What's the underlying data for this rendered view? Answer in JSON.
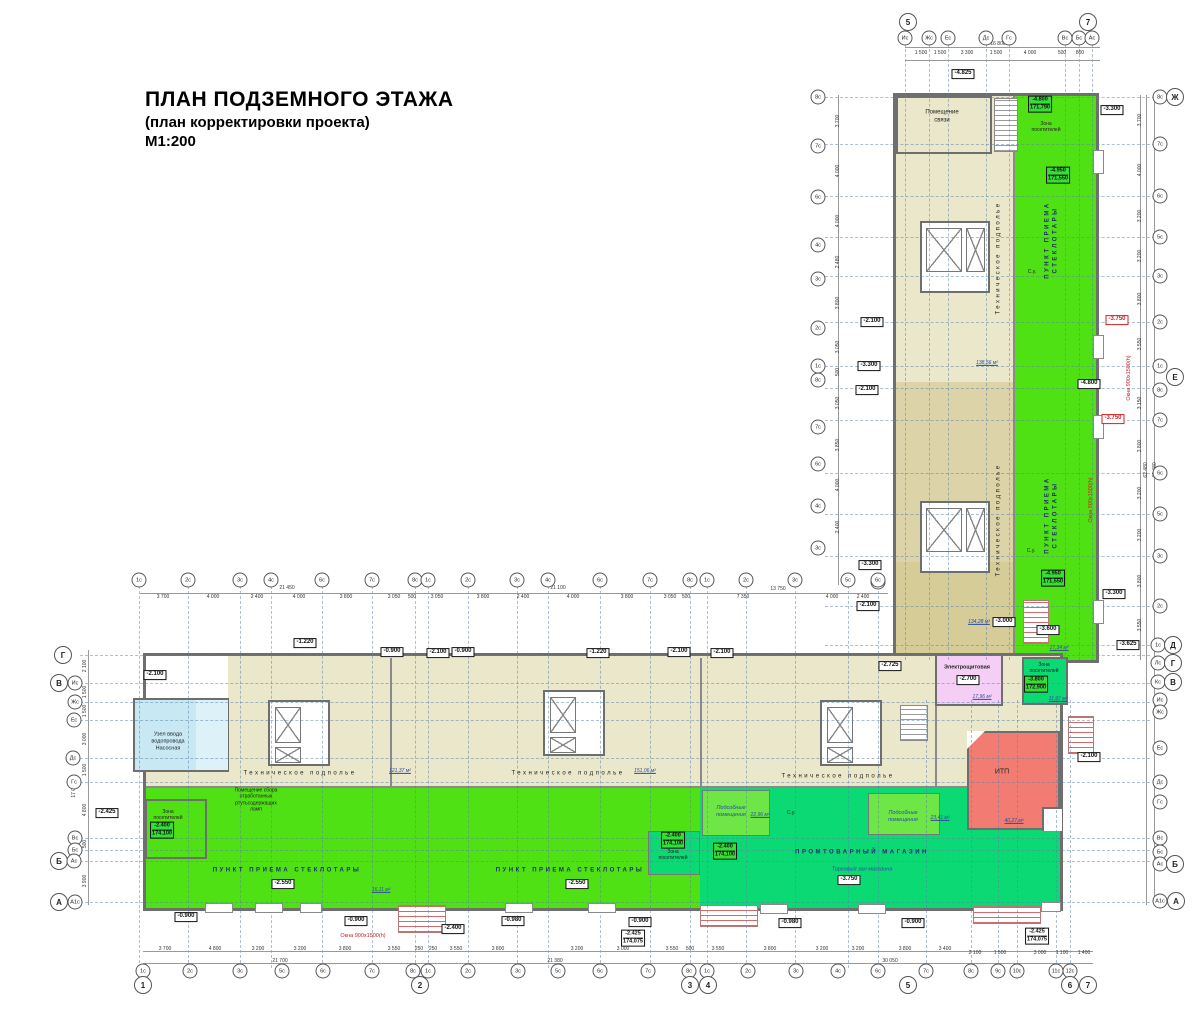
{
  "title": {
    "line1": "ПЛАН ПОДЗЕМНОГО ЭТАЖА",
    "line2": "(план корректировки проекта)",
    "line3": "М1:200"
  },
  "colors": {
    "technical_subfloor": "#ebe7ca",
    "glass_collection_point": "#50e114",
    "store": "#0bda74",
    "utility_rooms": "#6ee646",
    "water_inlet": "#c8e8f4",
    "electrical_room": "#f4cef4",
    "itp": "#f37c72",
    "note_red": "#cc2222",
    "label_navy": "#1b2f6b"
  },
  "rooms": {
    "communications": "Помещение связи",
    "technical_subfloor": "Техническое подполье",
    "glass_collection": "ПУНКТ ПРИЕМА СТЕКЛОТАРЫ",
    "store": "ПРОМТОВАРНЫЙ МАГАЗИН",
    "store_hall": "Торговый зал магазина",
    "utility": "Подсобные помещения",
    "visitors_zone": "Зона посетителей",
    "electrical": "Электрощитовая",
    "itp": "ИТП",
    "water_inlet": "Узел ввода водопровода Насосная",
    "lamp_collection": "Помещение сбора отработанных ртутьсодержащих ламп",
    "wc": "С.у."
  },
  "bubbles": [
    [
      "5",
      908,
      22,
      1
    ],
    [
      "7",
      1088,
      22,
      1
    ],
    [
      "Ис",
      905,
      38,
      0
    ],
    [
      "Жс",
      929,
      38,
      0
    ],
    [
      "Ес",
      948,
      38,
      0
    ],
    [
      "Дс",
      986,
      38,
      0
    ],
    [
      "Гс",
      1009,
      38,
      0
    ],
    [
      "Вс",
      1065,
      38,
      0
    ],
    [
      "Бс",
      1079,
      38,
      0
    ],
    [
      "Ас",
      1092,
      38,
      0
    ],
    [
      "8с",
      1160,
      97,
      0
    ],
    [
      "Ж",
      1175,
      97,
      1
    ],
    [
      "7с",
      1160,
      144,
      0
    ],
    [
      "6с",
      1160,
      196,
      0
    ],
    [
      "5с",
      1160,
      237,
      0
    ],
    [
      "3с",
      1160,
      276,
      0
    ],
    [
      "2с",
      1160,
      322,
      0
    ],
    [
      "1с",
      1160,
      366,
      0
    ],
    [
      "Е",
      1175,
      377,
      1
    ],
    [
      "8с",
      1160,
      390,
      0
    ],
    [
      "7с",
      1160,
      420,
      0
    ],
    [
      "6с",
      1160,
      473,
      0
    ],
    [
      "5с",
      1160,
      514,
      0
    ],
    [
      "3с",
      1160,
      556,
      0
    ],
    [
      "2с",
      1160,
      606,
      0
    ],
    [
      "1с",
      1158,
      645,
      0
    ],
    [
      "Д",
      1173,
      645,
      1
    ],
    [
      "Лс",
      1158,
      663,
      0
    ],
    [
      "Г",
      1173,
      663,
      1
    ],
    [
      "Кс",
      1158,
      682,
      0
    ],
    [
      "В",
      1173,
      682,
      1
    ],
    [
      "Ис",
      1160,
      700,
      0
    ],
    [
      "Жс",
      1160,
      712,
      0
    ],
    [
      "Ес",
      1160,
      748,
      0
    ],
    [
      "Дс",
      1160,
      782,
      0
    ],
    [
      "Гс",
      1160,
      802,
      0
    ],
    [
      "Вс",
      1160,
      838,
      0
    ],
    [
      "Бс",
      1160,
      852,
      0
    ],
    [
      "Ас",
      1160,
      864,
      0
    ],
    [
      "Б",
      1175,
      864,
      1
    ],
    [
      "А1с",
      1160,
      901,
      0
    ],
    [
      "А",
      1176,
      901,
      1
    ],
    [
      "8с",
      818,
      97,
      0
    ],
    [
      "7с",
      818,
      146,
      0
    ],
    [
      "6с",
      818,
      197,
      0
    ],
    [
      "4с",
      818,
      245,
      0
    ],
    [
      "3с",
      818,
      279,
      0
    ],
    [
      "2с",
      818,
      328,
      0
    ],
    [
      "1с",
      818,
      366,
      0
    ],
    [
      "8с",
      818,
      380,
      0
    ],
    [
      "7с",
      818,
      427,
      0
    ],
    [
      "6с",
      818,
      464,
      0
    ],
    [
      "4с",
      818,
      506,
      0
    ],
    [
      "3с",
      818,
      548,
      0
    ],
    [
      "6с",
      878,
      582,
      0
    ],
    [
      "Г",
      63,
      655,
      1
    ],
    [
      "В",
      59,
      683,
      1
    ],
    [
      "Ис",
      75,
      683,
      0
    ],
    [
      "Жс",
      75,
      702,
      0
    ],
    [
      "Ес",
      74,
      720,
      0
    ],
    [
      "Дс",
      73,
      758,
      0
    ],
    [
      "Гс",
      74,
      782,
      0
    ],
    [
      "Вс",
      75,
      838,
      0
    ],
    [
      "Бс",
      75,
      850,
      0
    ],
    [
      "Б",
      59,
      861,
      1
    ],
    [
      "Ас",
      74,
      861,
      0
    ],
    [
      "А",
      59,
      902,
      1
    ],
    [
      "А1с",
      75,
      902,
      0
    ],
    [
      "1с",
      139,
      580,
      0
    ],
    [
      "2с",
      188,
      580,
      0
    ],
    [
      "3с",
      240,
      580,
      0
    ],
    [
      "4с",
      271,
      580,
      0
    ],
    [
      "6с",
      322,
      580,
      0
    ],
    [
      "7с",
      372,
      580,
      0
    ],
    [
      "8с",
      415,
      580,
      0
    ],
    [
      "1с",
      428,
      580,
      0
    ],
    [
      "2с",
      468,
      580,
      0
    ],
    [
      "3с",
      517,
      580,
      0
    ],
    [
      "4с",
      548,
      580,
      0
    ],
    [
      "6с",
      600,
      580,
      0
    ],
    [
      "7с",
      650,
      580,
      0
    ],
    [
      "8с",
      690,
      580,
      0
    ],
    [
      "1с",
      707,
      580,
      0
    ],
    [
      "2с",
      746,
      580,
      0
    ],
    [
      "3с",
      795,
      580,
      0
    ],
    [
      "5с",
      848,
      580,
      0
    ],
    [
      "6с",
      878,
      580,
      0
    ],
    [
      "1с",
      143,
      971,
      0
    ],
    [
      "2с",
      190,
      971,
      0
    ],
    [
      "3с",
      240,
      971,
      0
    ],
    [
      "5с",
      282,
      971,
      0
    ],
    [
      "6с",
      323,
      971,
      0
    ],
    [
      "7с",
      372,
      971,
      0
    ],
    [
      "8с",
      413,
      971,
      0
    ],
    [
      "1с",
      428,
      971,
      0
    ],
    [
      "2с",
      468,
      971,
      0
    ],
    [
      "3с",
      518,
      971,
      0
    ],
    [
      "5с",
      558,
      971,
      0
    ],
    [
      "6с",
      600,
      971,
      0
    ],
    [
      "7с",
      648,
      971,
      0
    ],
    [
      "8с",
      689,
      971,
      0
    ],
    [
      "1с",
      707,
      971,
      0
    ],
    [
      "2с",
      748,
      971,
      0
    ],
    [
      "3с",
      796,
      971,
      0
    ],
    [
      "4с",
      838,
      971,
      0
    ],
    [
      "6с",
      878,
      971,
      0
    ],
    [
      "7с",
      926,
      971,
      0
    ],
    [
      "8с",
      971,
      971,
      0
    ],
    [
      "9с",
      998,
      971,
      0
    ],
    [
      "10с",
      1017,
      971,
      0
    ],
    [
      "11с",
      1056,
      971,
      0
    ],
    [
      "12с",
      1070,
      971,
      0
    ],
    [
      "1",
      143,
      985,
      1
    ],
    [
      "2",
      420,
      985,
      1
    ],
    [
      "3",
      690,
      985,
      1
    ],
    [
      "4",
      708,
      985,
      1
    ],
    [
      "5",
      908,
      985,
      1
    ],
    [
      "6",
      1070,
      985,
      1
    ],
    [
      "7",
      1088,
      985,
      1
    ]
  ],
  "notes": [
    [
      "-4.825",
      963,
      74,
      0
    ],
    [
      "-3.300",
      1112,
      110,
      0
    ],
    [
      "-2.100",
      872,
      322,
      0
    ],
    [
      "-3.300",
      869,
      366,
      0
    ],
    [
      "-2.100",
      867,
      390,
      0
    ],
    [
      "-4.800",
      1089,
      384,
      0
    ],
    [
      "-3.750",
      1117,
      320,
      1
    ],
    [
      "-3.750",
      1113,
      419,
      1
    ],
    [
      "-3.300",
      870,
      565,
      0
    ],
    [
      "-3.300",
      1114,
      594,
      0
    ],
    [
      "-2.100",
      868,
      606,
      0
    ],
    [
      "-3.000",
      1004,
      622,
      0
    ],
    [
      "-3.600",
      1048,
      630,
      0
    ],
    [
      "-3.625",
      1128,
      645,
      0
    ],
    [
      "-2.725",
      890,
      666,
      0
    ],
    [
      "-2.100",
      155,
      675,
      0
    ],
    [
      "-2.425",
      107,
      813,
      0
    ],
    [
      "-1.220",
      305,
      643,
      0
    ],
    [
      "-0.900",
      392,
      652,
      0
    ],
    [
      "-2.100",
      438,
      653,
      0
    ],
    [
      "-0.900",
      463,
      652,
      0
    ],
    [
      "-1.220",
      598,
      653,
      0
    ],
    [
      "-2.100",
      679,
      652,
      0
    ],
    [
      "-2.100",
      722,
      653,
      0
    ],
    [
      "-2.700",
      968,
      680,
      0
    ],
    [
      "-2.100",
      1089,
      757,
      0
    ],
    [
      "-2.550",
      283,
      884,
      0
    ],
    [
      "-2.550",
      577,
      884,
      0
    ],
    [
      "-3.750",
      849,
      880,
      0
    ],
    [
      "-0.900",
      186,
      917,
      0
    ],
    [
      "-0.900",
      356,
      921,
      0
    ],
    [
      "-2.400",
      453,
      929,
      0
    ],
    [
      "-0.980",
      513,
      921,
      0
    ],
    [
      "-0.900",
      640,
      922,
      0
    ],
    [
      "-0.980",
      790,
      923,
      0
    ],
    [
      "-0.900",
      913,
      923,
      0
    ]
  ],
  "value_boxes": [
    [
      "-4.800",
      "171,790",
      1040,
      104,
      0
    ],
    [
      "-4.950",
      "171,550",
      1058,
      175,
      0
    ],
    [
      "-4.950",
      "171,550",
      1053,
      578,
      0
    ],
    [
      "-3.800",
      "172,900",
      1036,
      684,
      0
    ],
    [
      "-2.400",
      "174,100",
      162,
      830,
      0
    ],
    [
      "-2.400",
      "174,100",
      673,
      840,
      0
    ],
    [
      "-2.400",
      "174,100",
      725,
      851,
      0
    ],
    [
      "-2.425",
      "174,075",
      633,
      938,
      1
    ],
    [
      "-2.425",
      "174,075",
      1037,
      936,
      1
    ]
  ],
  "labels": [
    {
      "t": "Помещение\nсвязи",
      "x": 942,
      "y": 117,
      "s": 6
    },
    {
      "t": "Техническое подполье",
      "x": 999,
      "y": 258,
      "s": 6,
      "ls": 1,
      "rot": 1
    },
    {
      "t": "Техническое подполье",
      "x": 999,
      "y": 520,
      "s": 6,
      "ls": 1,
      "rot": 1
    },
    {
      "t": "ПУНКТ ПРИЕМА\nСТЕКЛОТАРЫ",
      "x": 1052,
      "y": 240,
      "s": 6,
      "navy": 1,
      "ls": 1,
      "rot": 1
    },
    {
      "t": "ПУНКТ ПРИЕМА\nСТЕКЛОТАРЫ",
      "x": 1052,
      "y": 515,
      "s": 6,
      "navy": 1,
      "ls": 1,
      "rot": 1
    },
    {
      "t": "Техническое подполье",
      "x": 300,
      "y": 774,
      "s": 6,
      "ls": 1
    },
    {
      "t": "Техническое подполье",
      "x": 568,
      "y": 774,
      "s": 6,
      "ls": 1
    },
    {
      "t": "Техническое подполье",
      "x": 838,
      "y": 777,
      "s": 6,
      "ls": 1
    },
    {
      "t": "ПУНКТ ПРИЕМА СТЕКЛОТАРЫ",
      "x": 287,
      "y": 871,
      "s": 6,
      "navy": 1,
      "ls": 1
    },
    {
      "t": "ПУНКТ ПРИЕМА СТЕКЛОТАРЫ",
      "x": 570,
      "y": 871,
      "s": 6,
      "navy": 1,
      "ls": 1
    },
    {
      "t": "ПРОМТОВАРНЫЙ МАГАЗИН",
      "x": 862,
      "y": 853,
      "s": 6,
      "navy": 1,
      "ls": 1
    },
    {
      "t": "Торговый зал магазина",
      "x": 862,
      "y": 870,
      "s": 5.5,
      "it": 1
    },
    {
      "t": "Подсобные\nпомещения",
      "x": 731,
      "y": 812,
      "s": 5.5,
      "it": 1
    },
    {
      "t": "Подсобные\nпомещения",
      "x": 903,
      "y": 817,
      "s": 5.5,
      "it": 1
    },
    {
      "t": "Зона\nпосетителей",
      "x": 168,
      "y": 815,
      "s": 5
    },
    {
      "t": "Зона\nпосетителей",
      "x": 673,
      "y": 855,
      "s": 5
    },
    {
      "t": "Зона\nпосетителей",
      "x": 1044,
      "y": 668,
      "s": 5
    },
    {
      "t": "Зона\nпосетителей",
      "x": 1046,
      "y": 127,
      "s": 5
    },
    {
      "t": "Электрощитовая",
      "x": 967,
      "y": 668,
      "s": 5.5,
      "b": 1
    },
    {
      "t": "ИТП",
      "x": 1002,
      "y": 773,
      "s": 7
    },
    {
      "t": "Узел ввода\nводопровода\nНасосная",
      "x": 168,
      "y": 742,
      "s": 5.5
    },
    {
      "t": "Помещение сбора\nотработанных\nртутьсодержащих\nламп",
      "x": 256,
      "y": 800,
      "s": 5
    },
    {
      "t": "С.у.",
      "x": 791,
      "y": 813,
      "s": 5
    },
    {
      "t": "С.у.",
      "x": 1032,
      "y": 272,
      "s": 5
    },
    {
      "t": "С.у.",
      "x": 1031,
      "y": 551,
      "s": 5
    },
    {
      "t": "138,56 м²",
      "x": 987,
      "y": 363,
      "area": 1
    },
    {
      "t": "134,28 м²",
      "x": 979,
      "y": 622,
      "area": 1
    },
    {
      "t": "121,37 м²",
      "x": 400,
      "y": 771,
      "area": 1
    },
    {
      "t": "151,06 м²",
      "x": 645,
      "y": 771,
      "area": 1
    },
    {
      "t": "17,96 м²",
      "x": 982,
      "y": 697,
      "area": 1
    },
    {
      "t": "11,97 м²",
      "x": 1058,
      "y": 699,
      "area": 1
    },
    {
      "t": "17,34 м²",
      "x": 1059,
      "y": 648,
      "area": 1
    },
    {
      "t": "40,27 м²",
      "x": 1014,
      "y": 821,
      "area": 1
    },
    {
      "t": "23,41 м²",
      "x": 940,
      "y": 818,
      "area": 1
    },
    {
      "t": "22,96 м²",
      "x": 760,
      "y": 815,
      "area": 1
    },
    {
      "t": "16,11 м²",
      "x": 381,
      "y": 890,
      "area": 1
    }
  ],
  "red_texts": [
    [
      "Окна 900х1500(h)",
      363,
      936,
      0
    ],
    [
      "Окна 900х1500(h)",
      1091,
      500,
      1
    ],
    [
      "Окна 900х1500(h)",
      1129,
      378,
      1
    ]
  ],
  "dims": [
    [
      "1 500",
      921,
      53,
      0
    ],
    [
      "1 500",
      940,
      53,
      0
    ],
    [
      "3 300",
      967,
      53,
      0
    ],
    [
      "1 500",
      996,
      53,
      0
    ],
    [
      "4 000",
      1030,
      53,
      0
    ],
    [
      "500",
      1062,
      53,
      0
    ],
    [
      "800",
      1080,
      53,
      0
    ],
    [
      "16 800",
      998,
      44,
      0
    ],
    [
      "3 700",
      163,
      597,
      0
    ],
    [
      "4 000",
      213,
      597,
      0
    ],
    [
      "2 400",
      257,
      597,
      0
    ],
    [
      "4 000",
      299,
      597,
      0
    ],
    [
      "3 800",
      346,
      597,
      0
    ],
    [
      "3 050",
      394,
      597,
      0
    ],
    [
      "500",
      412,
      597,
      0
    ],
    [
      "3 050",
      437,
      597,
      0
    ],
    [
      "3 800",
      483,
      597,
      0
    ],
    [
      "2 400",
      523,
      597,
      0
    ],
    [
      "4 000",
      573,
      597,
      0
    ],
    [
      "3 800",
      627,
      597,
      0
    ],
    [
      "3 050",
      670,
      597,
      0
    ],
    [
      "500",
      686,
      597,
      0
    ],
    [
      "7 350",
      743,
      597,
      0
    ],
    [
      "4 000",
      832,
      597,
      0
    ],
    [
      "2 400",
      863,
      597,
      0
    ],
    [
      "21 450",
      287,
      588,
      0
    ],
    [
      "21 100",
      558,
      588,
      0
    ],
    [
      "13 750",
      778,
      589,
      0
    ],
    [
      "3 700",
      165,
      949,
      0
    ],
    [
      "4 800",
      215,
      949,
      0
    ],
    [
      "3 200",
      258,
      949,
      0
    ],
    [
      "3 200",
      300,
      949,
      0
    ],
    [
      "3 800",
      345,
      949,
      0
    ],
    [
      "3 550",
      394,
      949,
      0
    ],
    [
      "250",
      419,
      949,
      0
    ],
    [
      "250",
      433,
      949,
      0
    ],
    [
      "3 550",
      456,
      949,
      0
    ],
    [
      "3 800",
      498,
      949,
      0
    ],
    [
      "3 200",
      577,
      949,
      0
    ],
    [
      "3 000",
      623,
      949,
      0
    ],
    [
      "3 550",
      672,
      949,
      0
    ],
    [
      "500",
      690,
      949,
      0
    ],
    [
      "3 550",
      718,
      949,
      0
    ],
    [
      "3 800",
      770,
      949,
      0
    ],
    [
      "3 200",
      822,
      949,
      0
    ],
    [
      "3 200",
      858,
      949,
      0
    ],
    [
      "3 800",
      905,
      949,
      0
    ],
    [
      "3 400",
      945,
      949,
      0
    ],
    [
      "2 100",
      975,
      953,
      0
    ],
    [
      "1 500",
      1000,
      953,
      0
    ],
    [
      "3 000",
      1040,
      953,
      0
    ],
    [
      "1 100",
      1062,
      953,
      0
    ],
    [
      "1 400",
      1084,
      953,
      0
    ],
    [
      "21 700",
      280,
      961,
      0
    ],
    [
      "21 380",
      555,
      961,
      0
    ],
    [
      "30 050",
      890,
      961,
      0
    ],
    [
      "2 100",
      85,
      666,
      1
    ],
    [
      "1 500",
      85,
      692,
      1
    ],
    [
      "1 500",
      85,
      711,
      1
    ],
    [
      "3 000",
      85,
      739,
      1
    ],
    [
      "1 500",
      85,
      770,
      1
    ],
    [
      "4 800",
      85,
      810,
      1
    ],
    [
      "500",
      85,
      844,
      1
    ],
    [
      "3 900",
      85,
      881,
      1
    ],
    [
      "17 000",
      74,
      790,
      1
    ],
    [
      "62 480",
      1146,
      470,
      1
    ],
    [
      "62 480",
      1155,
      470,
      1
    ],
    [
      "3 700",
      1140,
      120,
      1
    ],
    [
      "4 000",
      1140,
      170,
      1
    ],
    [
      "3 200",
      1140,
      216,
      1
    ],
    [
      "3 200",
      1140,
      256,
      1
    ],
    [
      "3 800",
      1140,
      299,
      1
    ],
    [
      "3 550",
      1140,
      344,
      1
    ],
    [
      "3 150",
      1140,
      403,
      1
    ],
    [
      "3 800",
      1140,
      446,
      1
    ],
    [
      "3 200",
      1140,
      493,
      1
    ],
    [
      "3 200",
      1140,
      535,
      1
    ],
    [
      "3 800",
      1140,
      581,
      1
    ],
    [
      "3 550",
      1140,
      625,
      1
    ],
    [
      "3 700",
      838,
      121,
      1
    ],
    [
      "4 000",
      838,
      171,
      1
    ],
    [
      "4 000",
      838,
      221,
      1
    ],
    [
      "2 480",
      838,
      262,
      1
    ],
    [
      "3 800",
      838,
      303,
      1
    ],
    [
      "3 050",
      838,
      347,
      1
    ],
    [
      "500",
      838,
      372,
      1
    ],
    [
      "3 050",
      838,
      403,
      1
    ],
    [
      "3 850",
      838,
      445,
      1
    ],
    [
      "4 000",
      838,
      485,
      1
    ],
    [
      "2 400",
      838,
      527,
      1
    ]
  ]
}
